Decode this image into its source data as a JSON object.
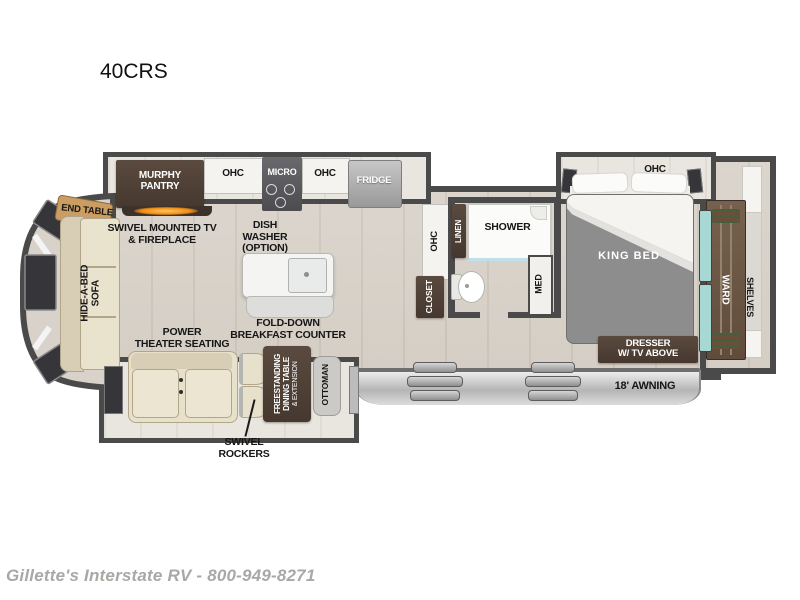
{
  "page": {
    "model": "40CRS",
    "watermark": "Gillette's Interstate RV - 800-949-8271"
  },
  "colors": {
    "wall": "#4a4a4a",
    "cabinet_brown": "#4f4038",
    "floor_wood": "#d9d3cb",
    "fireplace_glow": "#f09a2a",
    "ward_teal_doors": "#a7d9d4",
    "bed_gray": "#8d8d8d",
    "awning_gray": "#c6c6c6",
    "furniture_tan": "#e7e0cb",
    "window_dark": "#35353a"
  },
  "floorplan": {
    "kitchen": {
      "murphy_pantry_lines": [
        "MURPHY",
        "PANTRY"
      ],
      "ohc_left": "OHC",
      "micro": "MICRO",
      "ohc_right": "OHC",
      "fridge": "FRIDGE",
      "dish_washer_lines": [
        "DISH",
        "WASHER",
        "(OPTION)"
      ],
      "breakfast_counter_lines": [
        "FOLD-DOWN",
        "BREAKFAST COUNTER"
      ]
    },
    "living": {
      "end_table": "END TABLE",
      "tv_fireplace_lines": [
        "SWIVEL MOUNTED TV",
        "& FIREPLACE"
      ],
      "sofa_lines": [
        "HIDE-A-BED",
        "SOFA"
      ],
      "theater_lines": [
        "POWER",
        "THEATER SEATING"
      ],
      "swivel_rockers_lines": [
        "SWIVEL",
        "ROCKERS"
      ],
      "dining_table_lines": [
        "FREESTANDING",
        "DINING TABLE",
        "& EXTENSION"
      ],
      "ottoman": "OTTOMAN"
    },
    "bath": {
      "ohc": "OHC",
      "closet": "CLOSET",
      "linen": "LINEN",
      "shower": "SHOWER",
      "med": "MED"
    },
    "bedroom": {
      "ohc": "OHC",
      "king_bed": "KING BED",
      "ward": "WARD",
      "shelves": "SHELVES",
      "dresser_lines": [
        "DRESSER",
        "W/ TV ABOVE"
      ]
    },
    "exterior": {
      "awning": "18' AWNING"
    }
  }
}
